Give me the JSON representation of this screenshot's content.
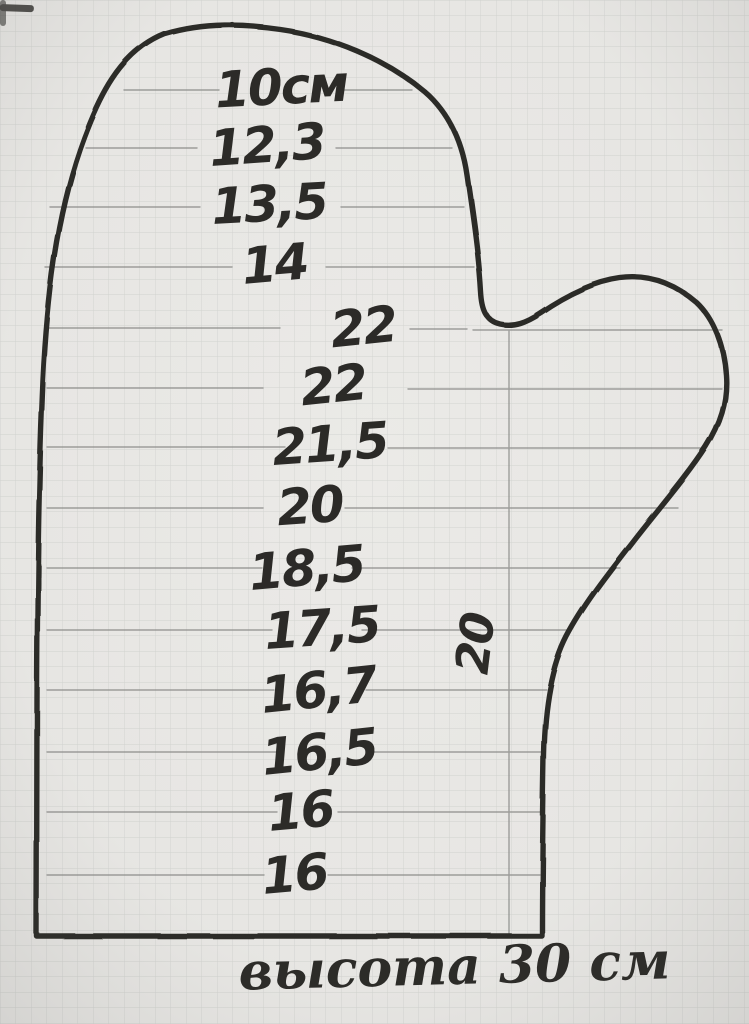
{
  "colors": {
    "paper": "#ebeae7",
    "grid": "#bfc2bf",
    "ink": "#2b2a27",
    "pencil": "#8b8c89"
  },
  "pattern": {
    "measurements": [
      "10см",
      "12,3",
      "13,5",
      "14",
      "22",
      "22",
      "21,5",
      "20",
      "18,5",
      "17,5",
      "16,7",
      "16,5",
      "16",
      "16"
    ],
    "thumb_width_label": "20",
    "caption": "высота 30 см"
  }
}
